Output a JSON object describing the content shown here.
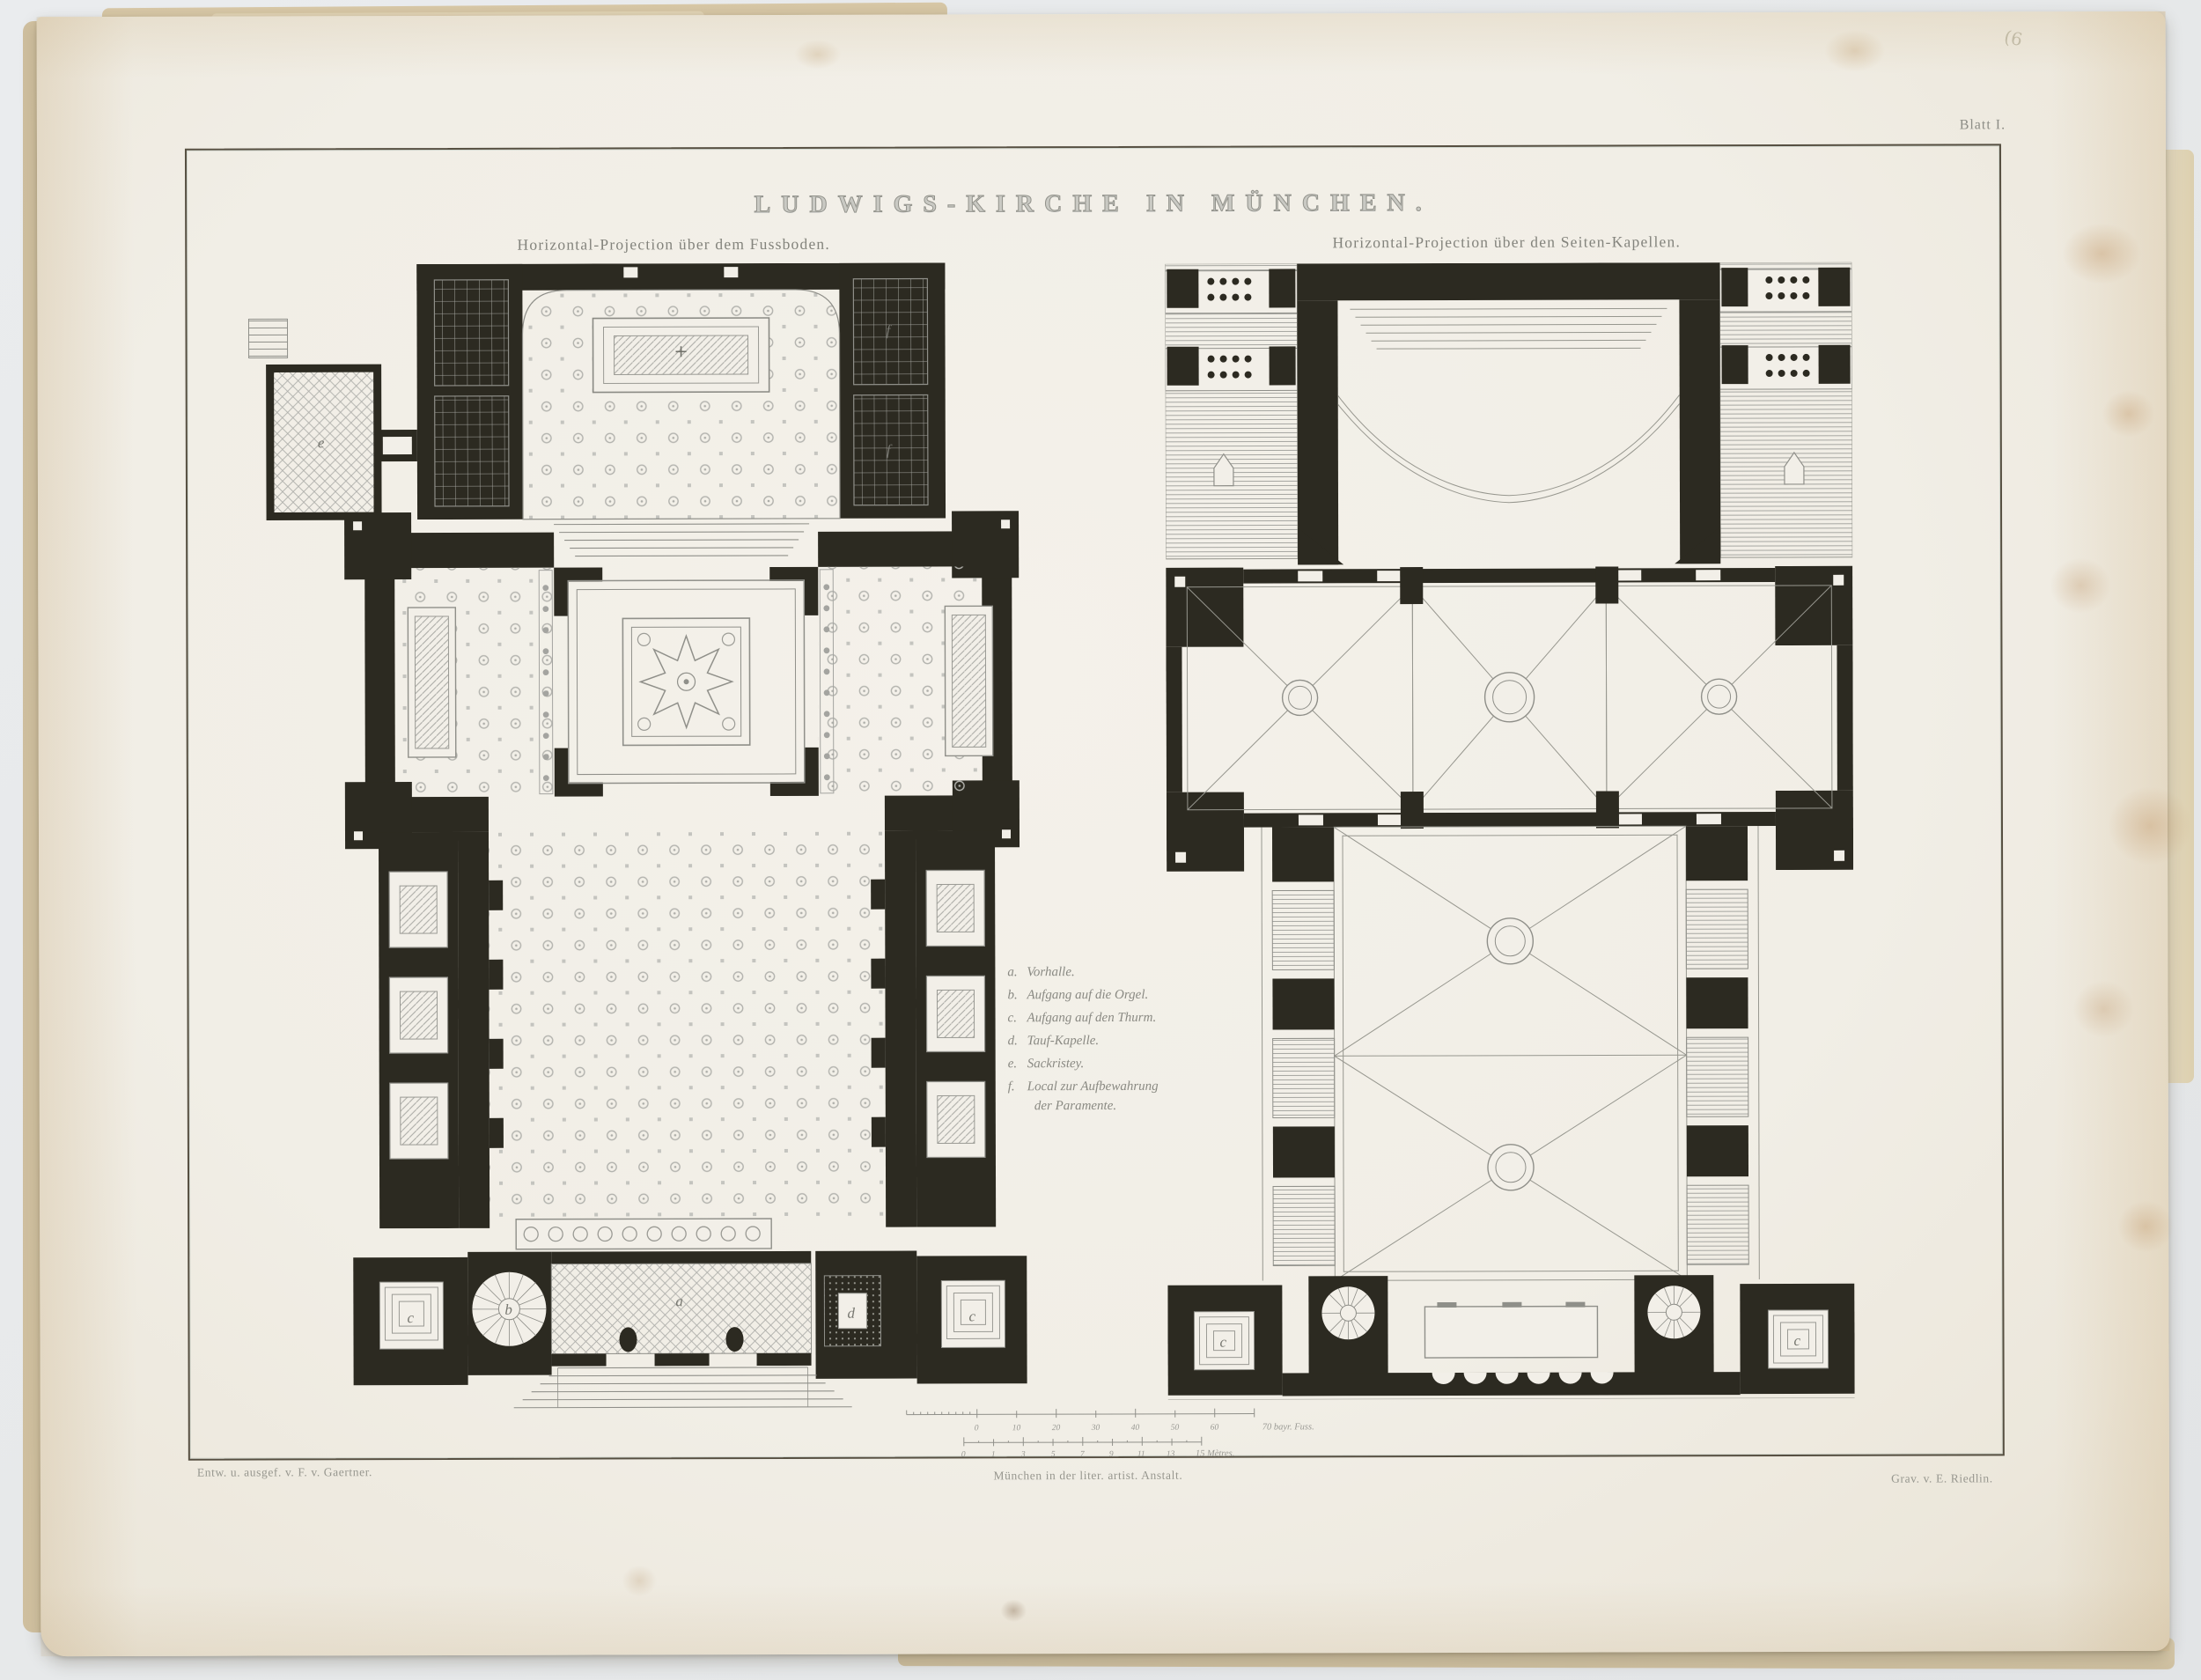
{
  "page": {
    "plate_number": "Blatt I.",
    "pencil_mark": "(6",
    "title": "LUDWIGS-KIRCHE IN MÜNCHEN.",
    "left_plan": {
      "subtitle": "Horizontal-Projection über dem Fussboden."
    },
    "right_plan": {
      "subtitle": "Horizontal-Projection über den Seiten-Kapellen."
    },
    "legend": {
      "items": [
        {
          "key": "a.",
          "label": "Vorhalle."
        },
        {
          "key": "b.",
          "label": "Aufgang auf die Orgel."
        },
        {
          "key": "c.",
          "label": "Aufgang auf den Thurm."
        },
        {
          "key": "d.",
          "label": "Tauf-Kapelle."
        },
        {
          "key": "e.",
          "label": "Sackristey."
        },
        {
          "key": "f.",
          "label": "Local zur Aufbewahrung",
          "label2": "der Paramente."
        }
      ]
    },
    "plan_letters": {
      "vorhalle": "a",
      "orgel_stair": "b",
      "thurm_stair": "c",
      "tauf_kapelle": "d",
      "sackristey": "e",
      "paramente": "f"
    },
    "scale": {
      "feet_labels": [
        "0",
        "10",
        "20",
        "30",
        "40",
        "50",
        "60"
      ],
      "feet_unit": "70 bayr. Fuss.",
      "metre_labels": [
        "0",
        "1",
        "3",
        "5",
        "7",
        "9",
        "11",
        "13"
      ],
      "metre_unit": "15 Mètres."
    },
    "credits": {
      "left": "Entw. u. ausgef. v. F. v. Gaertner.",
      "center": "München in der liter. artist. Anstalt.",
      "right": "Grav. v. E. Riedlin."
    }
  }
}
